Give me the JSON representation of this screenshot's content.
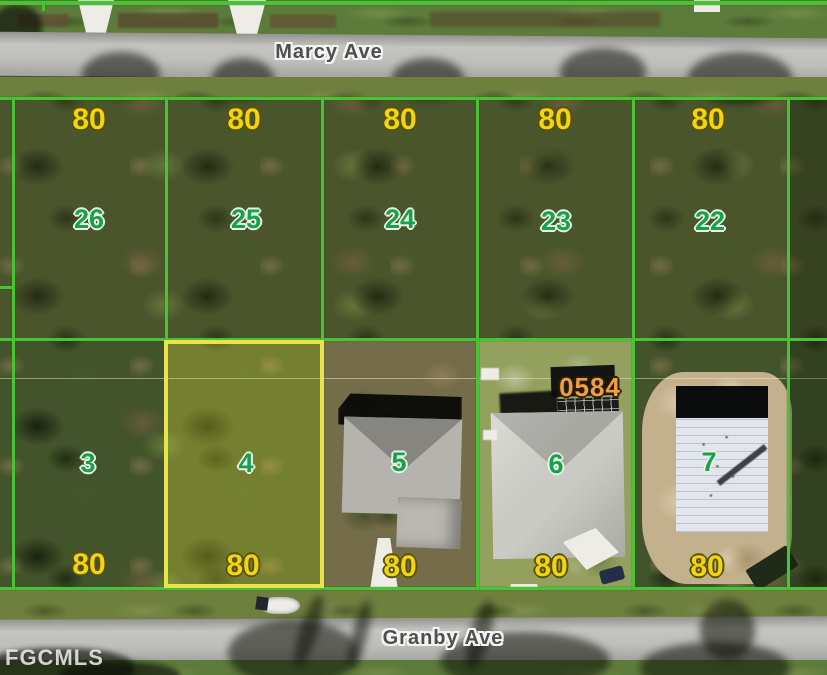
{
  "map": {
    "watermark": "FGCMLS",
    "annotation": "0584",
    "highlighted_lot": "4",
    "streets": [
      {
        "name": "Marcy Ave"
      },
      {
        "name": "Granby Ave"
      }
    ],
    "rows": [
      {
        "side": "marcy",
        "lots": [
          {
            "number": "26",
            "frontage": "80"
          },
          {
            "number": "25",
            "frontage": "80"
          },
          {
            "number": "24",
            "frontage": "80"
          },
          {
            "number": "23",
            "frontage": "80"
          },
          {
            "number": "22",
            "frontage": "80"
          }
        ]
      },
      {
        "side": "granby",
        "lots": [
          {
            "number": "3",
            "frontage": "80"
          },
          {
            "number": "4",
            "frontage": "80",
            "highlighted": true
          },
          {
            "number": "5",
            "frontage": "80"
          },
          {
            "number": "6",
            "frontage": "80"
          },
          {
            "number": "7",
            "frontage": "80"
          }
        ]
      }
    ],
    "colors": {
      "lot_line_green": "#4ac236",
      "highlight_yellow": "#e9e44a",
      "lot_number_green": "#17a14d",
      "frontage_yellow": "#f2d411",
      "annotation_orange": "#ee9f41",
      "street_text": "#4c4e50"
    }
  }
}
